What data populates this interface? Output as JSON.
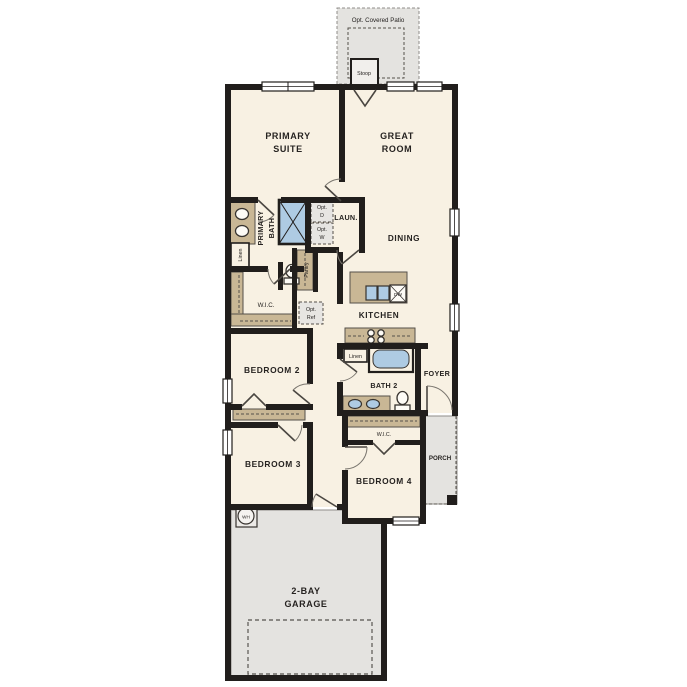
{
  "plan": {
    "labels": {
      "patio": "Opt. Covered Patio",
      "stoop": "Stoop",
      "primary_suite_1": "PRIMARY",
      "primary_suite_2": "SUITE",
      "great_room_1": "GREAT",
      "great_room_2": "ROOM",
      "primary_bath_1": "PRIMARY",
      "primary_bath_2": "BATH",
      "laundry": "LAUN.",
      "opt_d_1": "Opt.",
      "opt_d_2": "D",
      "opt_w_1": "Opt.",
      "opt_w_2": "W",
      "linen_primary": "Linen",
      "pantry": "Pantry",
      "dining": "DINING",
      "wic_primary": "W.I.C.",
      "opt_ref_1": "Opt.",
      "opt_ref_2": "Ref",
      "kitchen": "KITCHEN",
      "dishwasher": "DW",
      "bedroom2": "BEDROOM 2",
      "linen_hall": "Linen",
      "bath2": "BATH 2",
      "foyer": "FOYER",
      "bedroom3": "BEDROOM 3",
      "bedroom4": "BEDROOM 4",
      "wic_bed4": "W.I.C.",
      "porch": "PORCH",
      "water_heater": "WH",
      "garage_1": "2-BAY",
      "garage_2": "GARAGE"
    },
    "colors": {
      "floor": "#f8f1e3",
      "wall": "#211e1c",
      "cabinet_tan": "#c9b795",
      "exterior_gray": "#e4e3e0",
      "fixture_blue": "#aecbe3"
    }
  }
}
